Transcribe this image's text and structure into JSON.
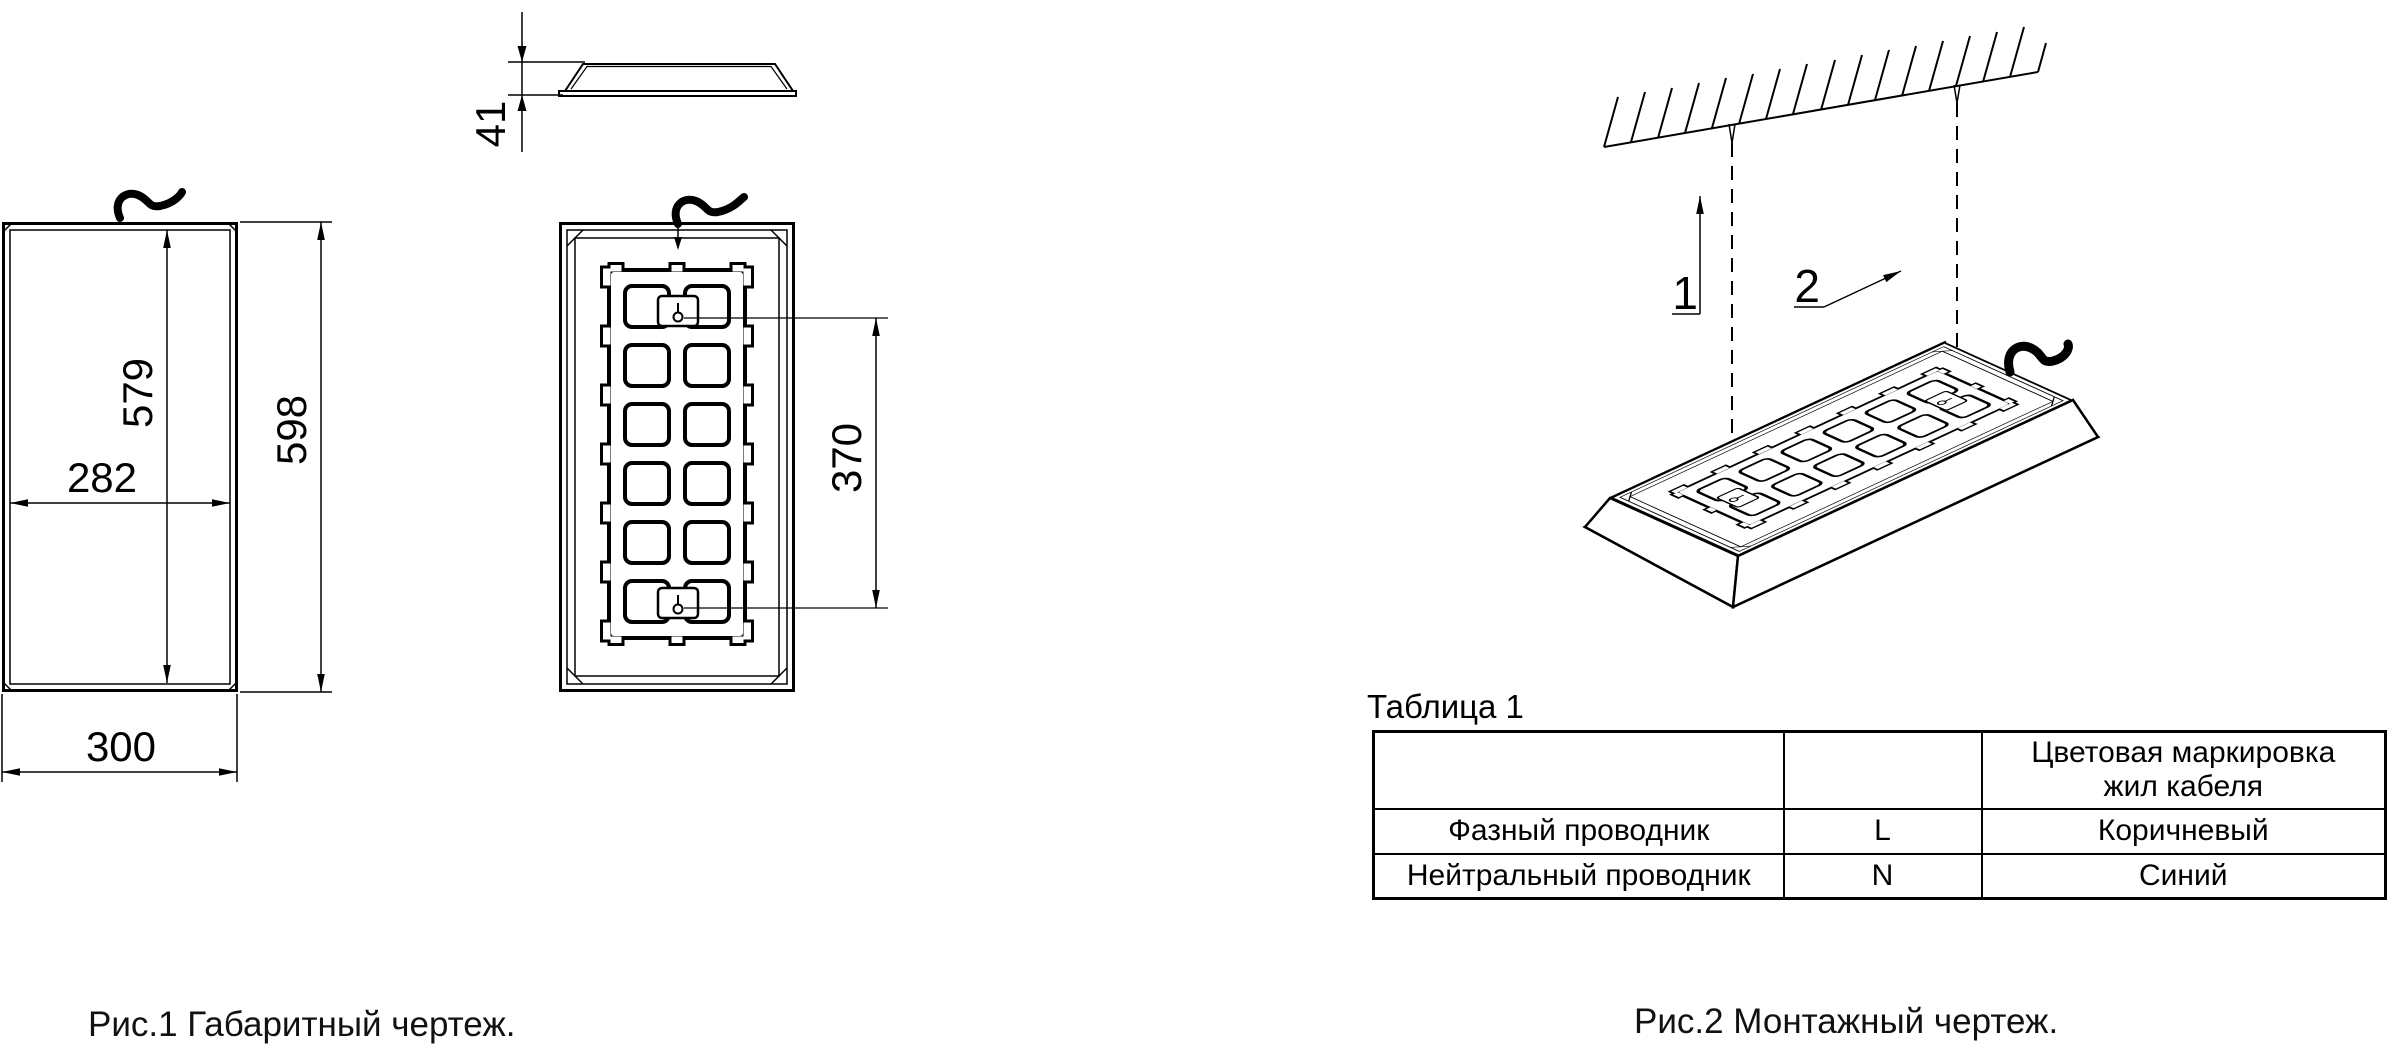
{
  "figure1": {
    "caption": "Рис.1 Габаритный чертеж.",
    "dims": {
      "depth": "41",
      "height_inner": "579",
      "height_overall": "598",
      "width_inner": "282",
      "width_overall": "300",
      "mount_spacing": "370"
    }
  },
  "figure2": {
    "caption": "Рис.2 Монтажный чертеж.",
    "callout1": "1",
    "callout2": "2",
    "table": {
      "title": "Таблица 1",
      "header_col3_line1": "Цветовая маркировка",
      "header_col3_line2": "жил кабеля",
      "rows": [
        {
          "name": "Фазный проводник",
          "symbol": "L",
          "color": "Коричневый"
        },
        {
          "name": "Нейтральный проводник",
          "symbol": "N",
          "color": "Синий"
        }
      ]
    }
  },
  "colors": {
    "line": "#000000",
    "background": "#ffffff"
  }
}
